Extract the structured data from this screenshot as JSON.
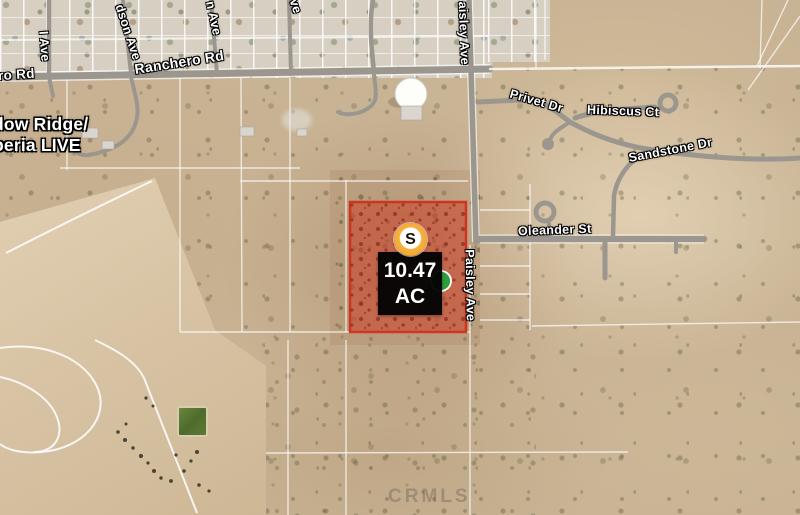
{
  "map": {
    "streets": [
      {
        "id": "i-ave",
        "text": "I Ave"
      },
      {
        "id": "dson-ave",
        "text": "dson Ave"
      },
      {
        "id": "n-ave",
        "text": "n Ave"
      },
      {
        "id": "ve",
        "text": "ve"
      },
      {
        "id": "ro-rd",
        "text": "ro Rd"
      },
      {
        "id": "ranchero-rd",
        "text": "Ranchero Rd"
      },
      {
        "id": "paisley-ave-top",
        "text": "aisley Ave"
      },
      {
        "id": "paisley-ave",
        "text": "Paisley Ave"
      },
      {
        "id": "privet-dr",
        "text": "Privet Dr"
      },
      {
        "id": "hibiscus-ct",
        "text": "Hibiscus Ct"
      },
      {
        "id": "sandstone-dr",
        "text": "Sandstone Dr"
      },
      {
        "id": "oleander-st",
        "text": "Oleander St"
      }
    ],
    "area_label": {
      "line1": "dow Ridge/",
      "line2": "peria LIVE"
    },
    "parcel": {
      "acreage": "10.47",
      "unit": "AC",
      "marker_letter": "S"
    },
    "watermark": "CRMLS",
    "colors": {
      "parcel_fill": "#c83c23",
      "marker_ring": "#f2a93b",
      "marker_secondary": "#2f9e3f",
      "road_gray": "#9b978f"
    }
  }
}
